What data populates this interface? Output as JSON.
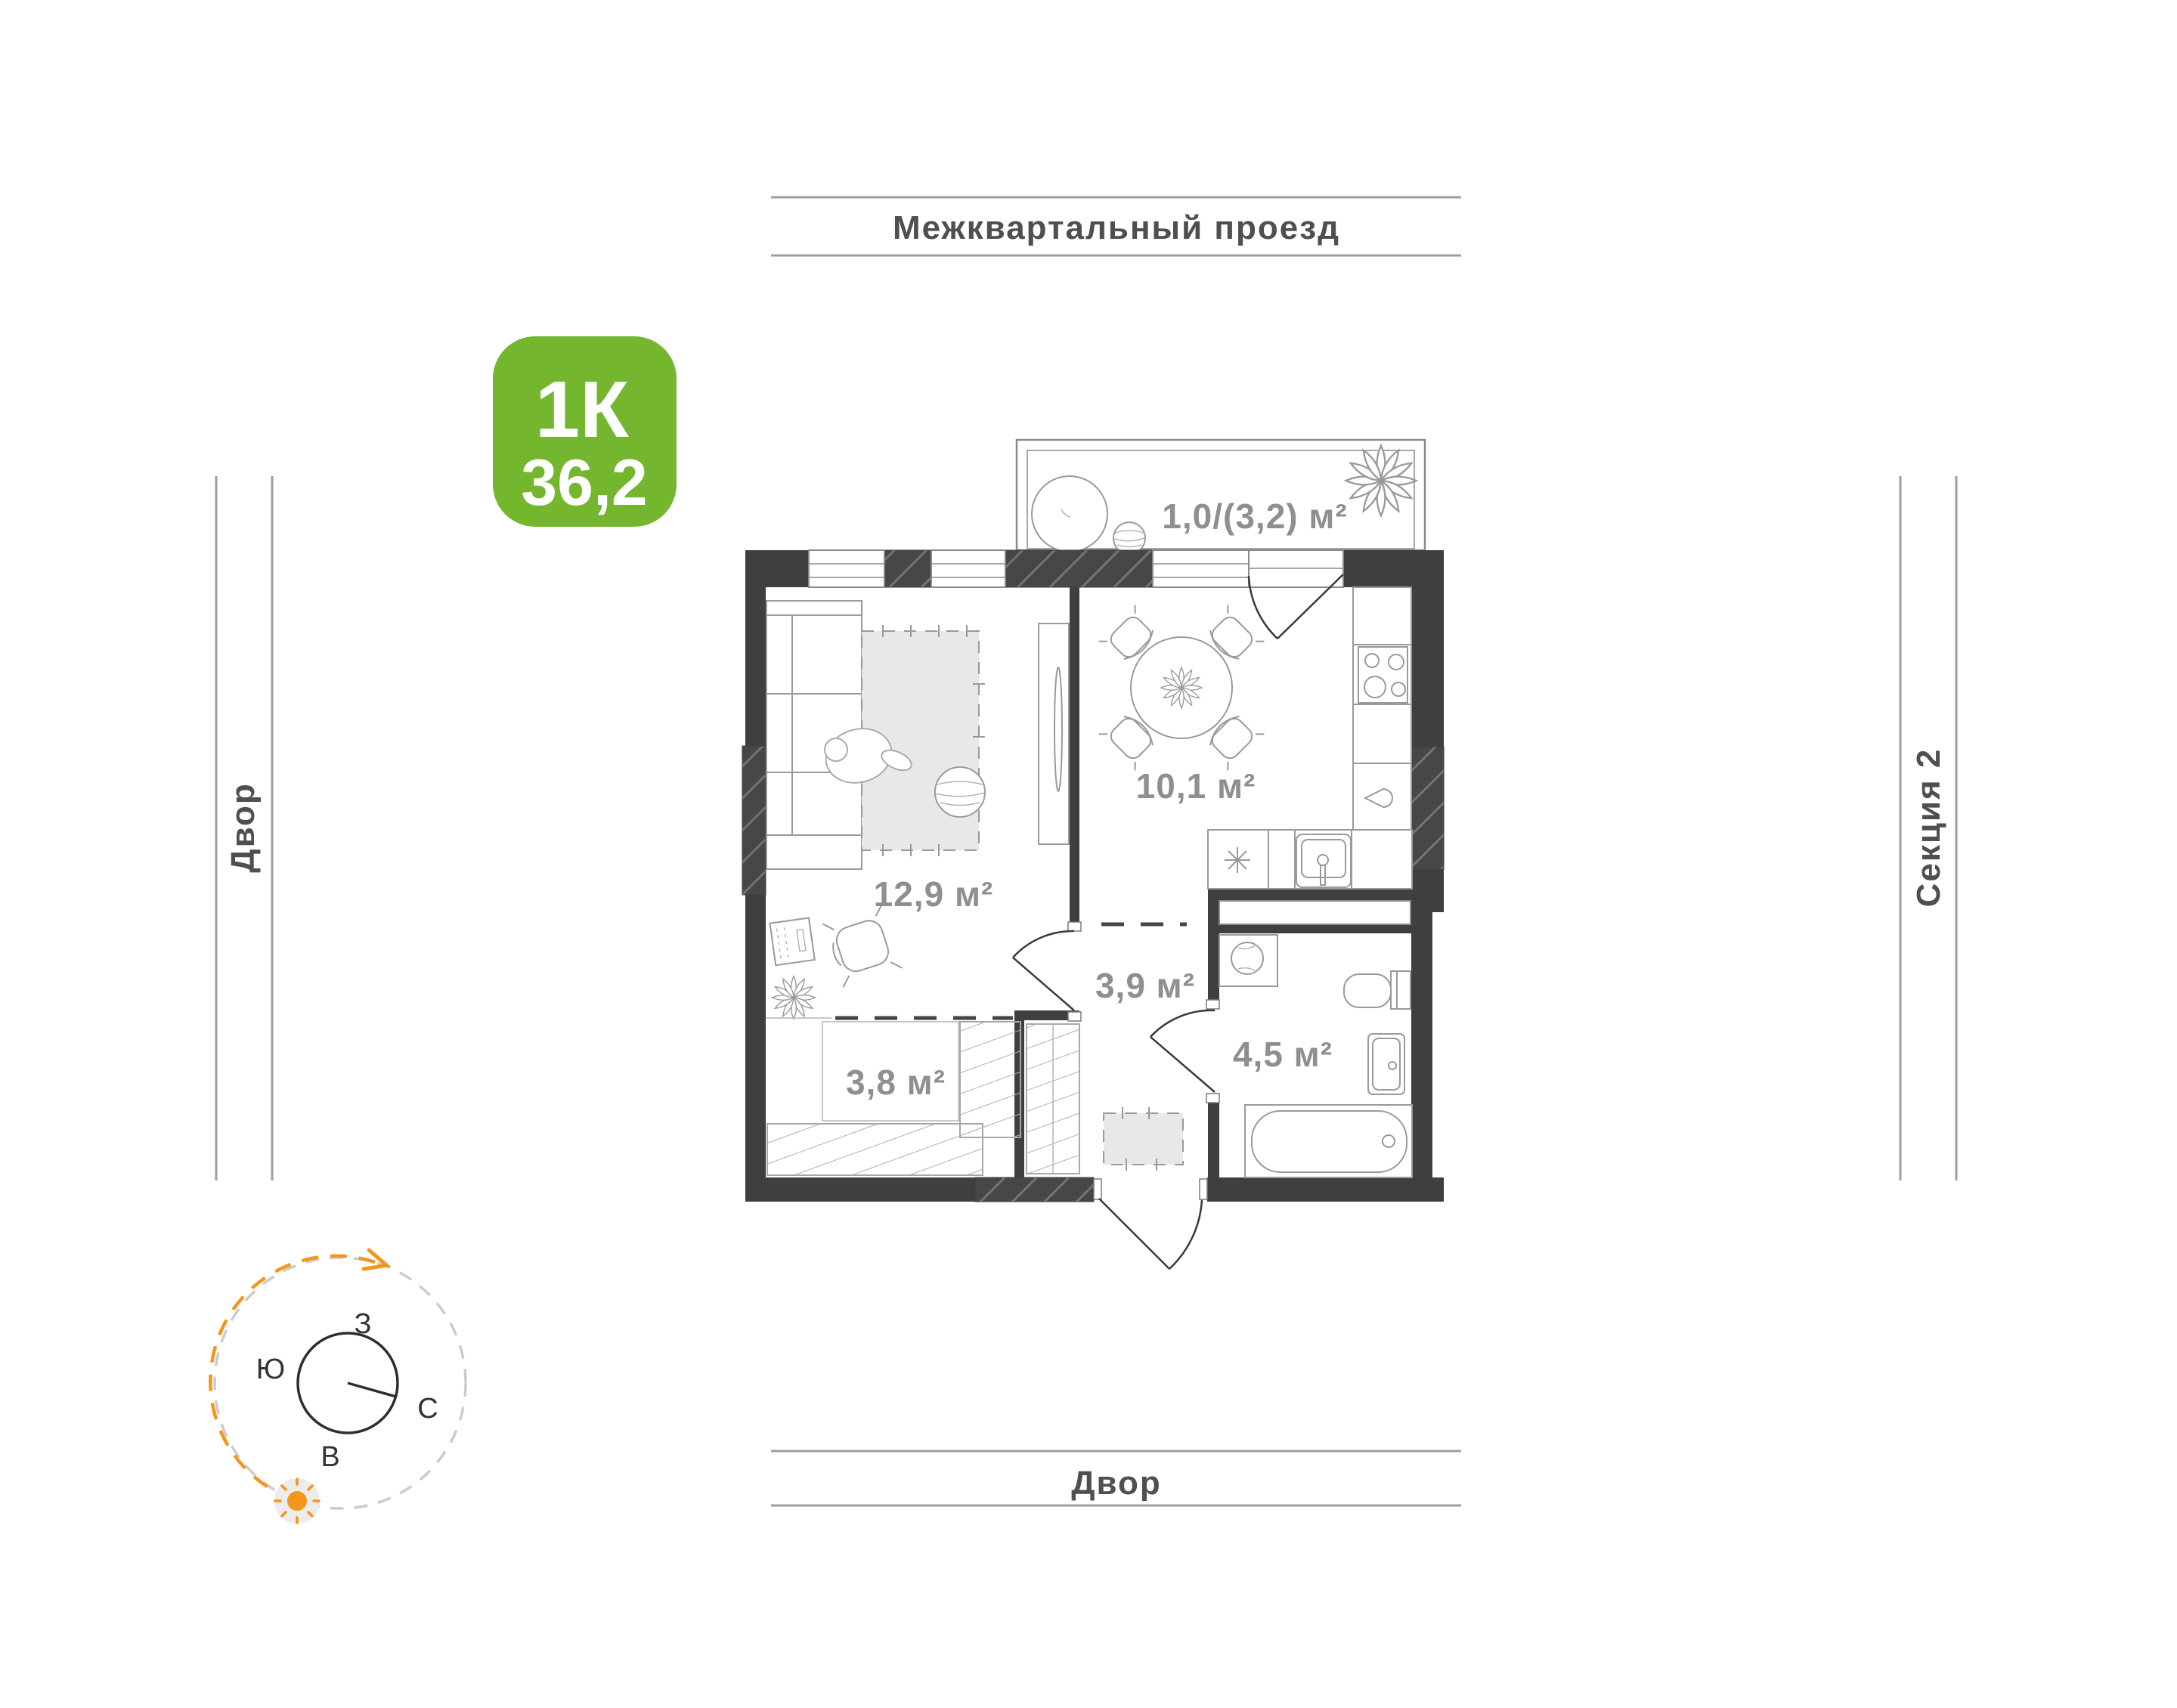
{
  "badge": {
    "type_label": "1К",
    "area_value": "36,2",
    "color": "#74B72E"
  },
  "surroundings": {
    "street_top": "Межквартальный проезд",
    "yard_left": "Двор",
    "yard_bottom": "Двор",
    "section_right": "Секция 2"
  },
  "rooms": {
    "balcony_area": "1,0/(3,2) м²",
    "kitchen_area": "10,1 м²",
    "living_area": "12,9 м²",
    "hallway_area": "3,9 м²",
    "bathroom_area": "4,5 м²",
    "wardrobe_area": "3,8 м²"
  },
  "compass": {
    "west": "З",
    "south": "Ю",
    "north": "С",
    "east": "В"
  },
  "colors": {
    "wall": "#3F3F3F",
    "green": "#74B72E",
    "orange": "#F2971B",
    "area_label": "#8F8F8F",
    "street_label": "#4F4F4F",
    "line_gray": "#9E9E9E"
  }
}
